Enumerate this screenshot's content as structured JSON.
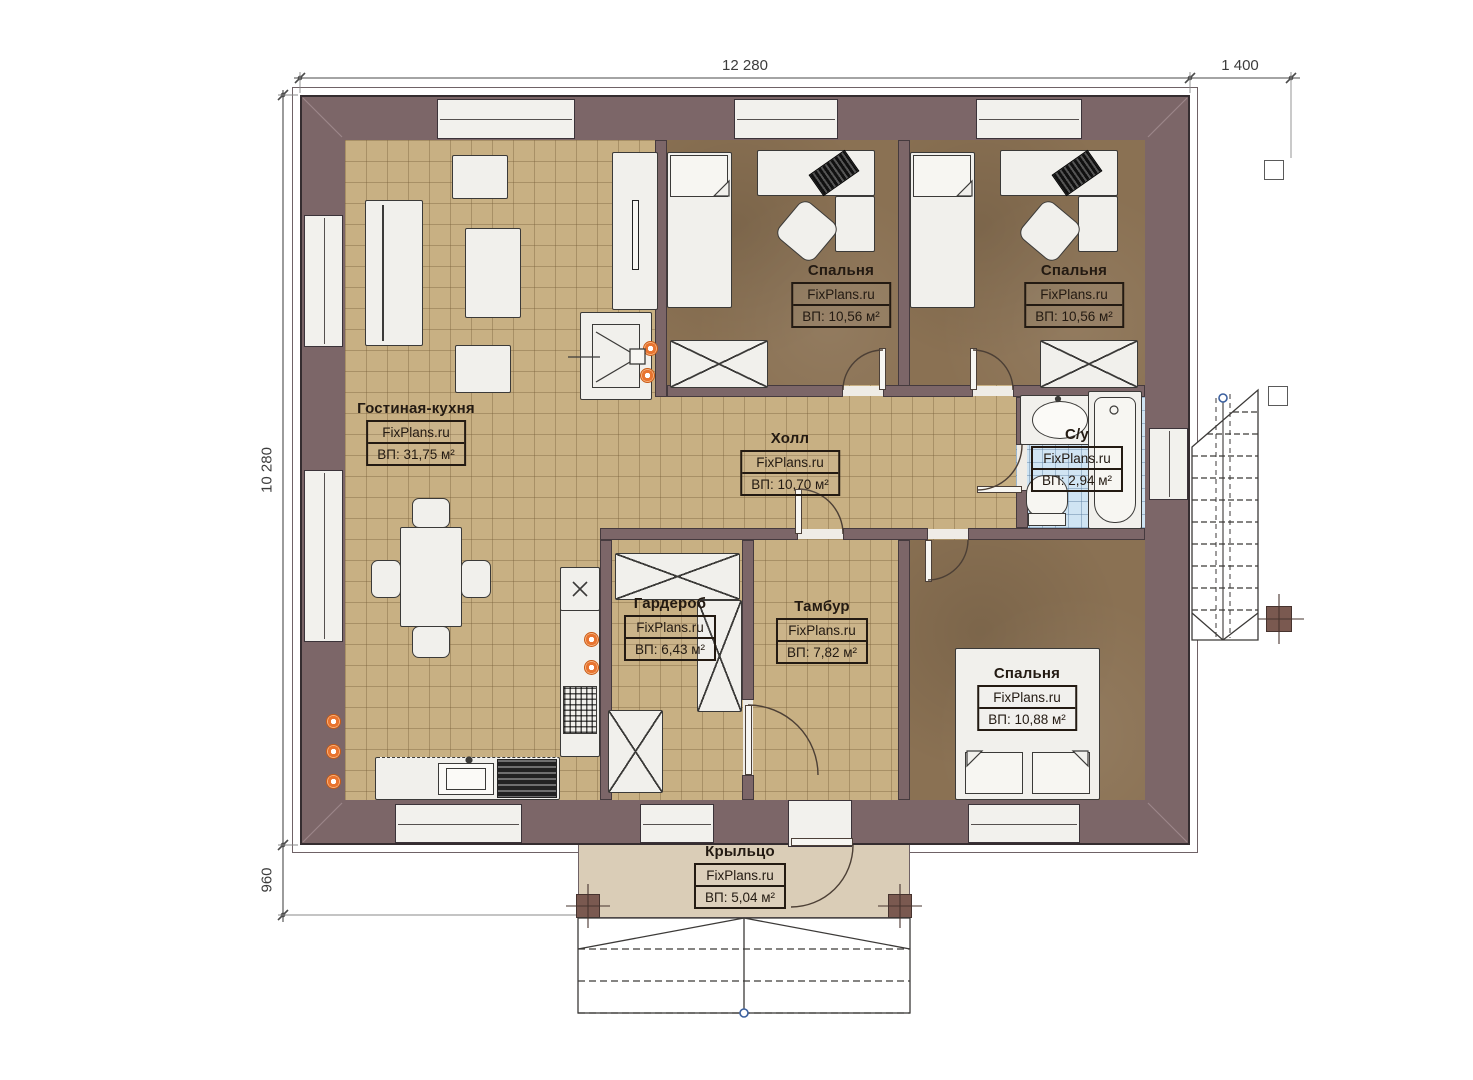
{
  "brand": {
    "watermark": "FixPlans.ru"
  },
  "dimensions": {
    "top_width": "12 280",
    "top_right_width": "1 400",
    "left_height": "10 280",
    "left_porch": "960"
  },
  "rooms": {
    "living": {
      "name": "Гостиная-кухня",
      "area": "ВП: 31,75 м²"
    },
    "bedroom1": {
      "name": "Спальня",
      "area": "ВП: 10,56 м²"
    },
    "bedroom2": {
      "name": "Спальня",
      "area": "ВП: 10,56 м²"
    },
    "hall": {
      "name": "Холл",
      "area": "ВП: 10,70 м²"
    },
    "bathroom": {
      "name": "С/у",
      "area": "ВП: 2,94 м²"
    },
    "wardrobe": {
      "name": "Гардероб",
      "area": "ВП: 6,43 м²"
    },
    "vestibule": {
      "name": "Тамбур",
      "area": "ВП: 7,82 м²"
    },
    "bedroom3": {
      "name": "Спальня",
      "area": "ВП: 10,88 м²"
    },
    "porch": {
      "name": "Крыльцо",
      "area": "ВП: 5,04 м²"
    }
  }
}
